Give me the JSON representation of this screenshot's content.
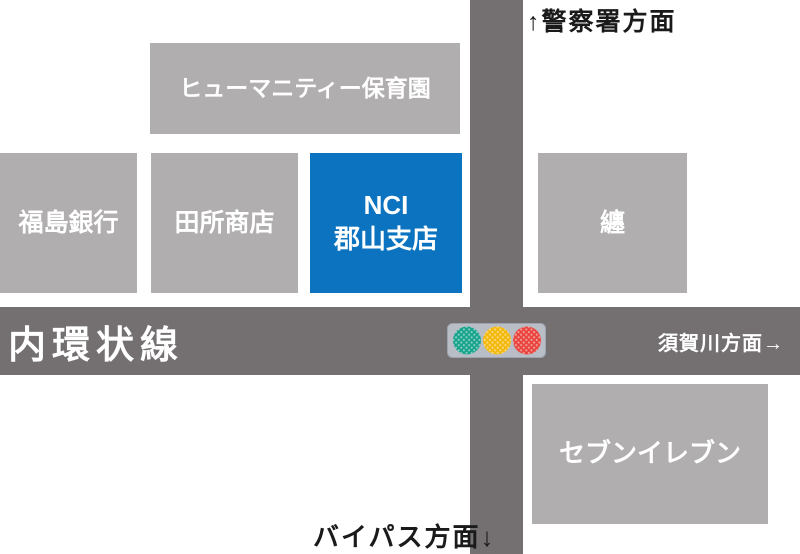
{
  "map": {
    "colors": {
      "road": "#747072",
      "building": "#b1aeaf",
      "highlight": "#0b73bf",
      "ink": "#1a1a1a",
      "block_text": "#ffffff",
      "signal_box": "#b9bdc6",
      "signal_box_border": "#9fa3ad"
    },
    "roads": {
      "horizontal": {
        "name": "内環状線"
      }
    },
    "directions": {
      "police": "↑警察署方面",
      "sukagawa": "須賀川方面→",
      "bypass": "バイパス方面↓"
    },
    "buildings": {
      "nursery": {
        "label": "ヒューマニティー保育園"
      },
      "bank": {
        "label": "福島銀行"
      },
      "tadokoro": {
        "label": "田所商店"
      },
      "nci": {
        "line1": "NCI",
        "line2": "郡山支店"
      },
      "matoi": {
        "label": "纏"
      },
      "seven_eleven": {
        "label": "セブンイレブン"
      }
    },
    "traffic_light": {
      "green": "#18a38c",
      "yellow": "#f4b80a",
      "red": "#e8433c"
    }
  }
}
